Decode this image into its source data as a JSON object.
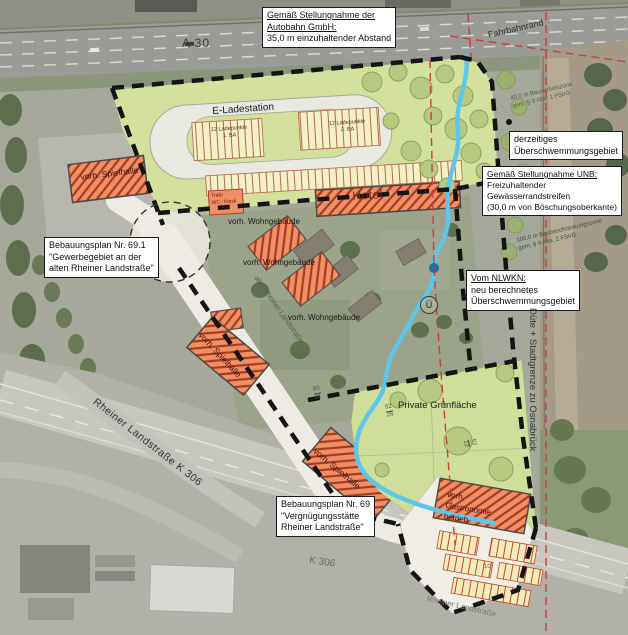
{
  "map_title": "Bebauungsplan Lageplan (Luftbild)",
  "boxes": {
    "autobahn": {
      "lines": [
        "Gemäß Stellungnahme der",
        "Autobahn GmbH:",
        "35,0 m einzuhaltender Abstand"
      ]
    },
    "flood_current": {
      "lines": [
        "derzeitiges",
        "Überschwemmungsgebiet"
      ]
    },
    "unb": {
      "lines": [
        "Gemäß Stellungnahme UNB:",
        "Freizuhaltender",
        "Gewässerrandstreifen",
        "(30,0 m von Böschungsoberkante)"
      ]
    },
    "nlwkn": {
      "lines": [
        "Vom NLWKN:",
        "neu berechnetes",
        "Überschwemmungsgebiet"
      ]
    },
    "bplan691": {
      "lines": [
        "Bebauungsplan Nr. 69.1",
        "\"Gewerbegebiet an der",
        "alten Rheiner Landstraße\""
      ]
    },
    "bplan69": {
      "lines": [
        "Bebauungsplan Nr. 69",
        "\"Vergnügungsstätte",
        "Rheiner Landstraße\""
      ]
    }
  },
  "labels": {
    "a30": {
      "text": "A 30"
    },
    "fahrbahnrand": {
      "text": "Fahrbahnrand"
    },
    "bauverbot": {
      "line1": "40,0 m Bauverbotszone",
      "line2": "gem. § 9 Abs. 1 FStrG"
    },
    "baubeschraenkung": {
      "line1": "100,0 m Baubeschränkungszone",
      "line2": "gem. § 9 Abs. 2 FStrG"
    },
    "e_ladestation": {
      "text": "E-Ladestation"
    },
    "ladepunkte1": {
      "line1": "12 Ladepunkte",
      "line2": "1. BA"
    },
    "ladepunkte2": {
      "line1": "12 Ladepunkte",
      "line2": "2. BA"
    },
    "trafo": {
      "line1": "Trafo",
      "line2": "WC / Kiosk"
    },
    "hotel": {
      "text": "Hotel"
    },
    "spielhalle_nw": {
      "text": "vorh. Spielhalle"
    },
    "spielhalle_mid": {
      "text": "vorh. Spielhalle"
    },
    "spielhalle_s": {
      "text": "vorh. Spielhalle"
    },
    "wohngebaeude_1": {
      "text": "vorh. Wohngebäude"
    },
    "wohngebaeude_2": {
      "text": "vorh. Wohngebäude"
    },
    "wohngebaeude_3": {
      "text": "vorh. Wohngebäude"
    },
    "private_gruen": {
      "text": "Private Grünfläche"
    },
    "gastronomie": {
      "line1": "vorh.",
      "line2": "Gastronomie",
      "line3": "betrieb"
    },
    "rheiner_k306": {
      "text": "Rheiner Landstraße  K 306"
    },
    "k306": {
      "text": "K 306"
    },
    "rheiner_bottom": {
      "text": "Rheiner Landstraße"
    },
    "alte_rheiner": {
      "text": "alte  Rheiner  Landstraße"
    },
    "duete": {
      "text": "Düte + Stadtgrenze zu Osnabrück"
    },
    "ue_symbol": {
      "text": "Ü"
    },
    "parcel_80_21": {
      "top": "80",
      "bottom": "21"
    },
    "parcel_52_26": {
      "top": "52",
      "bottom": "26"
    },
    "parcel_52_12": {
      "top": "52",
      "bottom": "12"
    },
    "parcel_10": {
      "text": "10"
    }
  },
  "colors": {
    "plan_green": "#d3e19d",
    "private_green": "#cfdf9a",
    "building_orange": "#ef8f63",
    "hatch_red": "#a63b22",
    "stall_yellow": "#f6f0c6",
    "stream_blue": "#5ec6e8",
    "boundary_black": "#141414",
    "restriction_red": "#c84038",
    "road_white": "#edebe4"
  }
}
